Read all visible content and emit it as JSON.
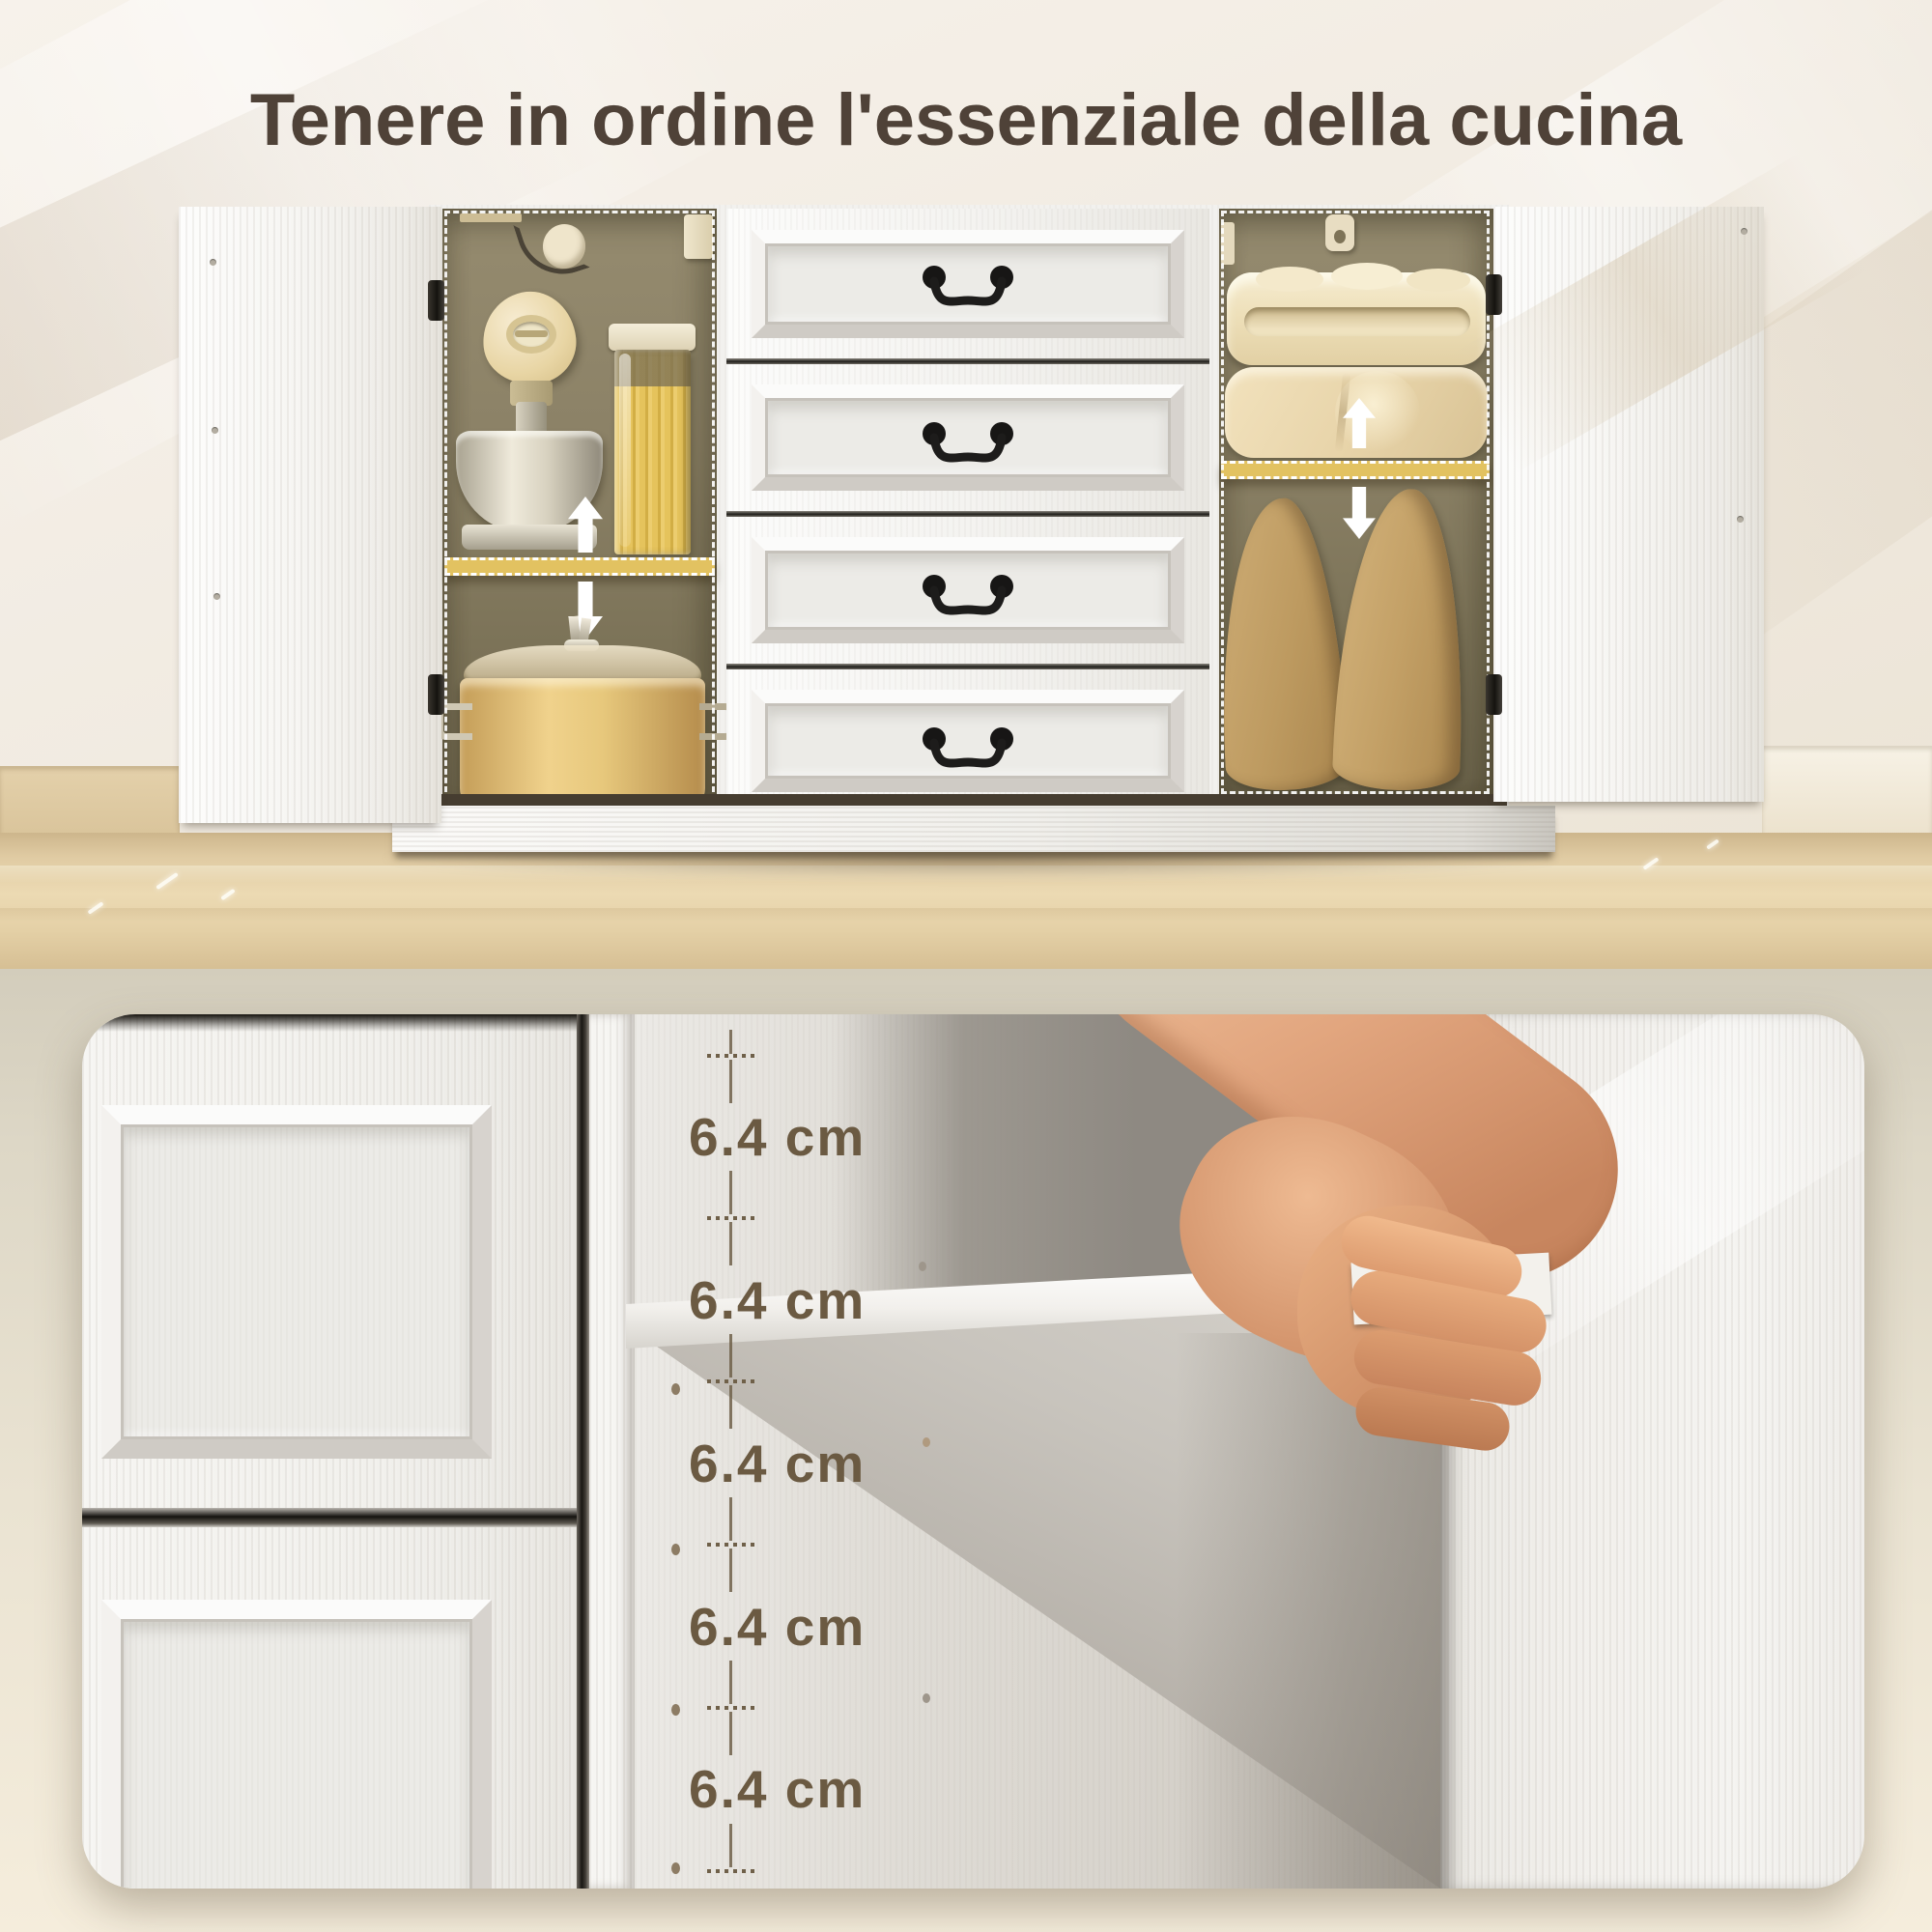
{
  "page": {
    "title": "Tenere in ordine l'essenziale della cucina"
  },
  "measurements": {
    "labels": [
      "6.4 cm",
      "6.4 cm",
      "6.4 cm",
      "6.4 cm",
      "6.4 cm"
    ],
    "value": "6.4",
    "unit": "cm",
    "count": 5
  },
  "icons": {
    "arrow_up": "block-arrow-up",
    "arrow_down": "block-arrow-down",
    "hook": "hanging-hook",
    "hinge": "door-hinge",
    "tick": "dotted-measure-tick"
  },
  "colors": {
    "shelf_highlight": "#e2c261",
    "cabinet_top_wood": "#53331c",
    "measure_text": "#6b5a42",
    "title_text": "#4f4238",
    "backdrop_top": "#f2ece2",
    "backdrop_bottom": "#e7e0cf"
  }
}
